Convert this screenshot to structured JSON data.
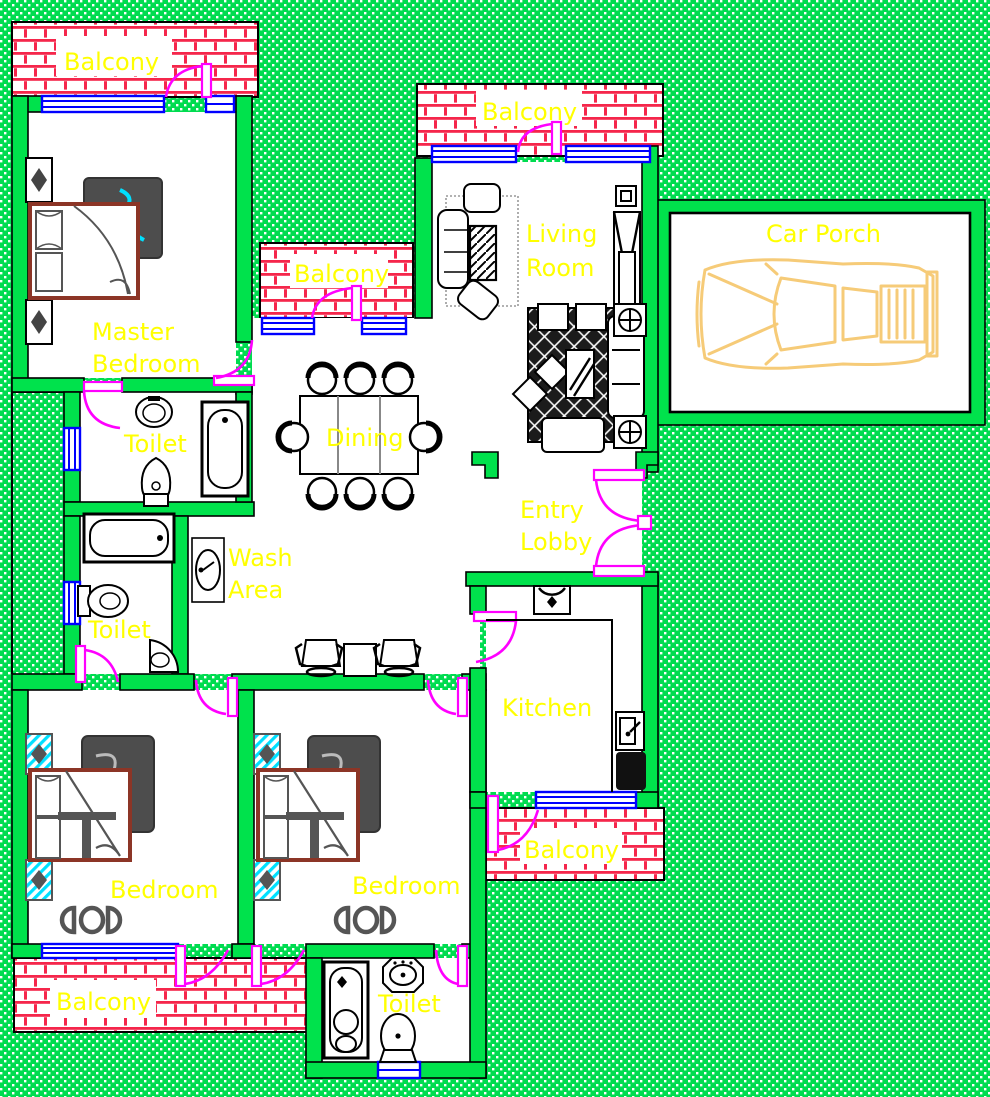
{
  "drawing_title": "house-floor-plan",
  "rooms": {
    "balcony_top_left": {
      "label": "Balcony"
    },
    "balcony_top": {
      "label": "Balcony"
    },
    "balcony_mid": {
      "label": "Balcony"
    },
    "balcony_kitchen": {
      "label": "Balcony"
    },
    "balcony_bottom": {
      "label": "Balcony"
    },
    "master_bedroom": {
      "line1": "Master",
      "line2": "Bedroom"
    },
    "living_room": {
      "line1": "Living",
      "line2": "Room"
    },
    "car_porch": {
      "label": "Car Porch"
    },
    "toilet_master": {
      "label": "Toilet"
    },
    "toilet_2": {
      "label": "Toilet"
    },
    "toilet_3": {
      "label": "Toilet"
    },
    "dining": {
      "label": "Dining"
    },
    "entry_lobby": {
      "line1": "Entry",
      "line2": "Lobby"
    },
    "wash_area": {
      "line1": "Wash",
      "line2": "Area"
    },
    "kitchen": {
      "label": "Kitchen"
    },
    "bedroom_1": {
      "label": "Bedroom"
    },
    "bedroom_2": {
      "label": "Bedroom"
    }
  },
  "counts": {
    "dining_chairs": 8,
    "bedrooms": 3,
    "toilets": 3,
    "balconies": 5
  },
  "colors": {
    "background_green": "#00DC50",
    "wall_green": "#00E24C",
    "balcony_hatch_red": "#F5264B",
    "door_magenta": "#FF00FF",
    "window_blue": "#0000FF",
    "label_yellow": "#FFFF00",
    "car_body_yellow": "#F6CB78",
    "bed_frame_brown": "#8C3526",
    "accent_cyan": "#00E0FF"
  }
}
